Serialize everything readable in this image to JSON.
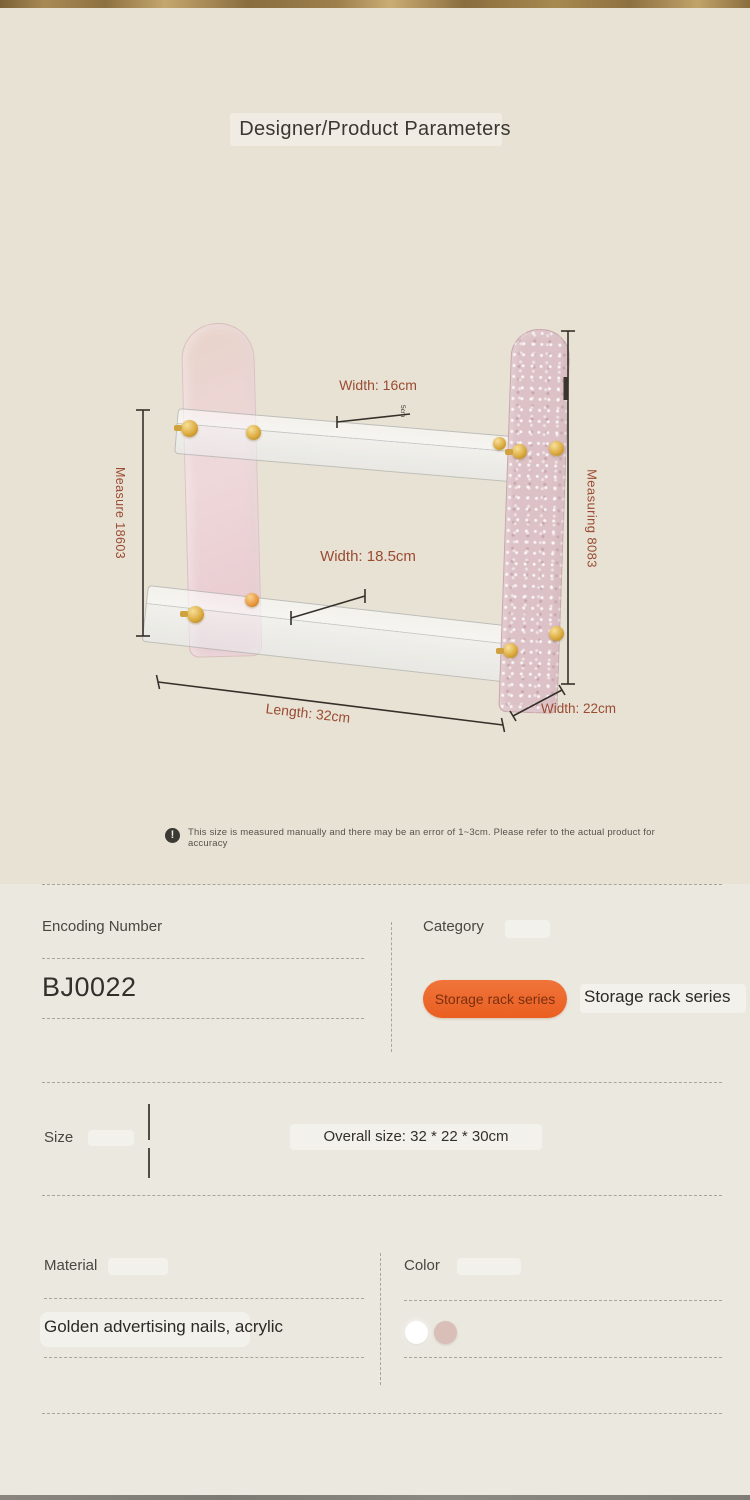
{
  "header": {
    "title": "Designer/Product Parameters"
  },
  "figure": {
    "labels": {
      "width_top": "Width: 16cm",
      "width_mid": "Width: 18.5cm",
      "height_left": "Measure 18603",
      "height_right": "Measuring 8083",
      "length": "Length: 32cm",
      "depth": "Width: 22cm",
      "tiny_mark": "5cm"
    }
  },
  "disclaimer": {
    "text": "This size is measured manually and there may be an error of 1~3cm. Please refer to the actual product for accuracy"
  },
  "params": {
    "encoding": {
      "label": "Encoding Number",
      "value": "BJ0022"
    },
    "category": {
      "label": "Category",
      "tag": "Storage rack series",
      "value": "Storage rack series"
    },
    "size": {
      "label": "Size",
      "value": "Overall size: 32 * 22 * 30cm"
    },
    "material": {
      "label": "Material",
      "value": "Golden advertising nails, acrylic"
    },
    "color": {
      "label": "Color",
      "swatches": [
        {
          "name": "white",
          "hex": "#ffffff"
        },
        {
          "name": "pink",
          "hex": "#d9bfb8"
        }
      ]
    }
  },
  "colors": {
    "accent_pill": "linear-gradient(180deg,#f0743a,#ea5f21)",
    "dimension_text": "#9a4b31",
    "hero_background": "#e8e2d5",
    "lower_background": "#ebe8e0"
  }
}
